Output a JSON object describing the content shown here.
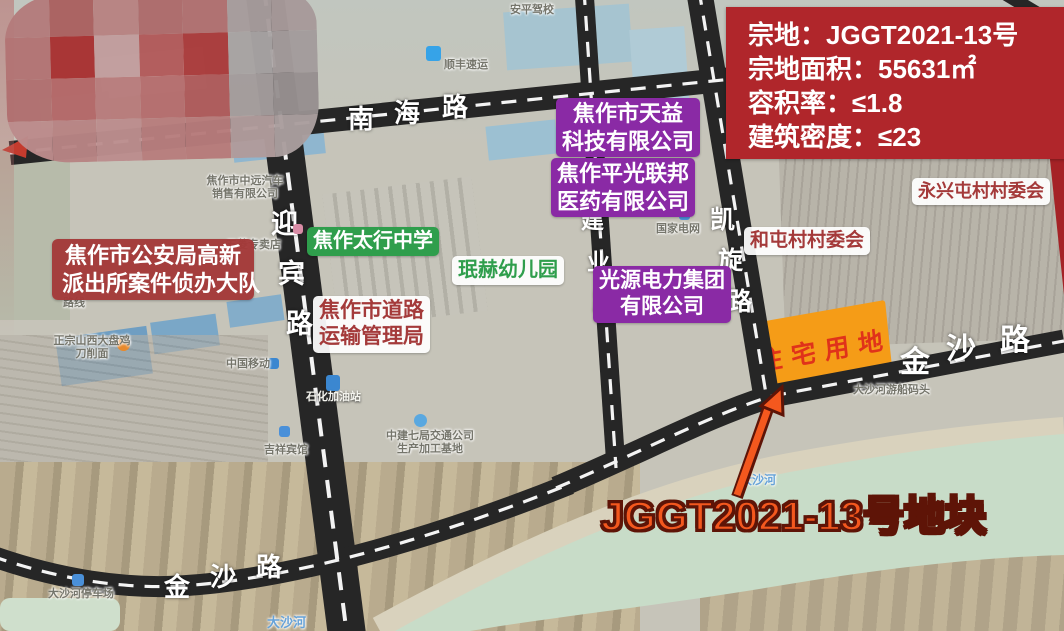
{
  "info_box": {
    "lines": [
      "宗地：JGGT2021-13号",
      "宗地面积：55631㎡",
      "容积率：≤1.8",
      "建筑密度：≤23"
    ]
  },
  "roads": {
    "nanhai": "南海路",
    "yingbin": "迎宾路",
    "jianye": "建业路",
    "kaixuan": "凯旋路",
    "jinsha_left": "金沙路",
    "jinsha_right": "金沙路"
  },
  "landmarks": {
    "police": {
      "lines": [
        "焦作市公安局高新",
        "派出所案件侦办大队"
      ]
    },
    "taihang_school": {
      "lines": [
        "焦作太行中学"
      ]
    },
    "minhe_kindergarten": {
      "lines": [
        "珉赫幼儿园"
      ]
    },
    "transport_bureau": {
      "lines": [
        "焦作市道路",
        "运输管理局"
      ]
    },
    "tianyi": {
      "lines": [
        "焦作市天益",
        "科技有限公司"
      ]
    },
    "pingguang": {
      "lines": [
        "焦作平光联邦",
        "医药有限公司"
      ]
    },
    "guangyuan": {
      "lines": [
        "光源电力集团",
        "有限公司"
      ]
    },
    "hetun": {
      "lines": [
        "和屯村村委会"
      ]
    },
    "yongxingtun": {
      "lines": [
        "永兴屯村村委会"
      ]
    }
  },
  "parcel": {
    "land_use": "住宅用地",
    "callout": "JGGT2021-13号地块"
  },
  "pois": [
    {
      "line1": "焦作市中远汽车",
      "line2": "销售有限公司"
    },
    {
      "line1": "五菱专卖店",
      "icon": "shop-icon"
    },
    {
      "line1": "顺丰速运",
      "icon": "sf-express-icon"
    },
    {
      "line1": "安平驾校"
    },
    {
      "line1": "国家电网",
      "icon": "state-grid-icon"
    },
    {
      "line1": "路线"
    },
    {
      "line1": "正宗山西大盘鸡",
      "line2": "刀削面",
      "icon": "restaurant-icon"
    },
    {
      "line1": "中国移动",
      "icon": "china-mobile-icon"
    },
    {
      "line1": "石化加油站",
      "icon": "gas-station-icon"
    },
    {
      "line1": "中建七局交通公司",
      "line2": "生产加工基地",
      "icon": "company-icon"
    },
    {
      "line1": "吉祥宾馆",
      "icon": "hotel-icon"
    },
    {
      "line1": "大沙河游船码头"
    },
    {
      "line1": "大沙河"
    },
    {
      "line1": "大沙河"
    },
    {
      "line1": "大沙河停车场",
      "icon": "parking-icon"
    }
  ],
  "colors": {
    "info_box_bg": "#b0262b",
    "company_label_bg": "#8a2aa5",
    "school_label_bg": "#2f9e4c",
    "village_label_text": "#a43a3a",
    "parcel_fill": "#f59c17",
    "parcel_text": "#e0321a",
    "callout_text": "#f4581e",
    "road_color": "#262626"
  },
  "censor_mosaic": {
    "colors": [
      "#b47c7c",
      "#ab6161",
      "#b88383",
      "#ae6c6c",
      "#b07070",
      "#a79c9c",
      "#a89a9a",
      "#b37474",
      "#a93232",
      "#c19d9d",
      "#b25a5a",
      "#aa3b3b",
      "#a8a3a3",
      "#a49c9c",
      "#b17070",
      "#b46868",
      "#b87c7c",
      "#b56e6e",
      "#ae5a5a",
      "#a39c9c",
      "#979090",
      "#bc8c8c",
      "#b88484",
      "#bc8e8e",
      "#b87e7e",
      "#b77b7b",
      "#b19c9c",
      "#aa9e9e"
    ]
  }
}
